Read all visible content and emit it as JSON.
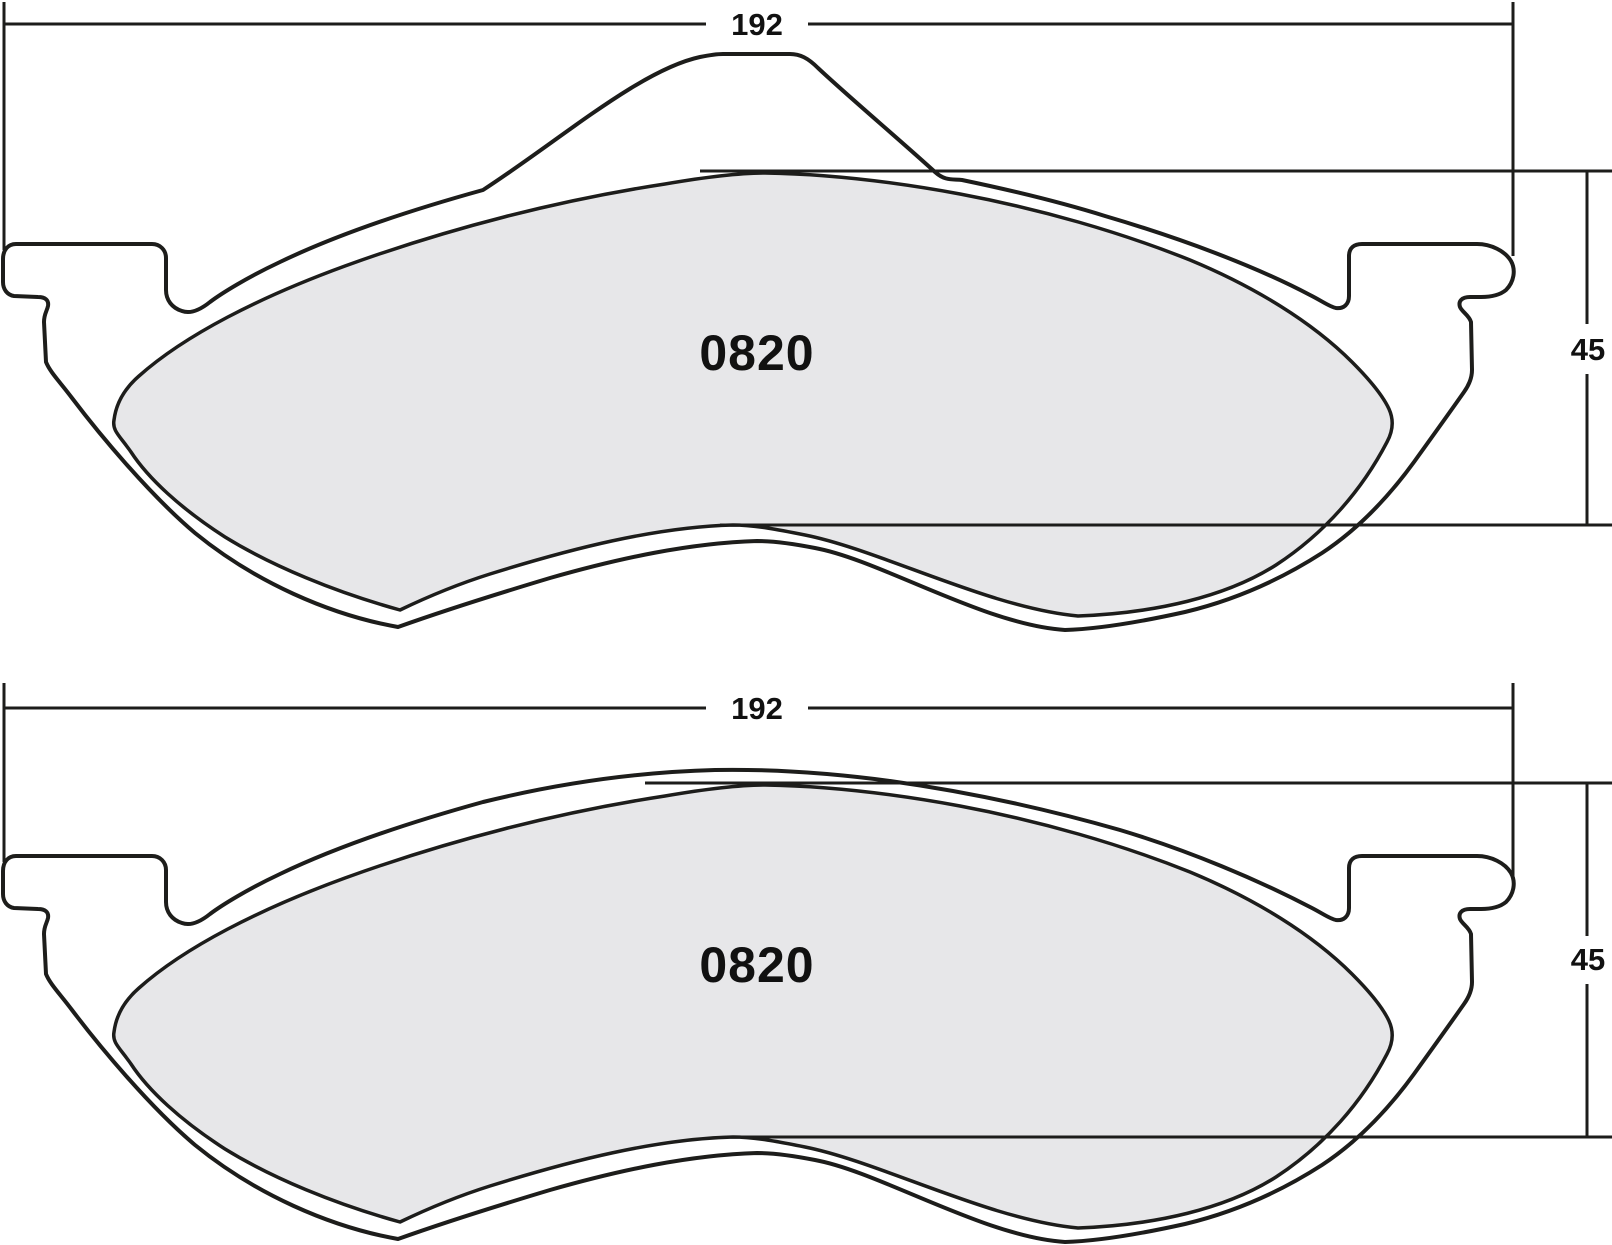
{
  "drawing": {
    "type": "brake-pad-dimension-drawing",
    "pads": [
      {
        "position": "top",
        "part_number": "0820",
        "width_dim": "192",
        "height_dim": "45",
        "has_top_hump": true
      },
      {
        "position": "bottom",
        "part_number": "0820",
        "width_dim": "192",
        "height_dim": "45",
        "has_top_hump": false
      }
    ],
    "colors": {
      "line": "#1d1d1b",
      "friction_fill": "#e7e7e9",
      "background": "#ffffff"
    }
  }
}
